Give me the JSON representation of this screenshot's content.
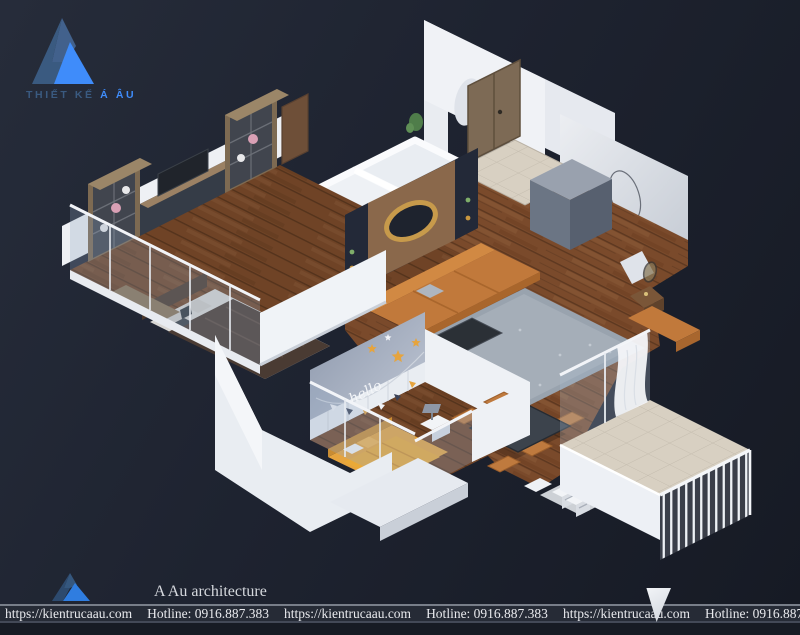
{
  "branding": {
    "logo_top": {
      "title_prefix": "THIẾT KẾ ",
      "title_accent": "Á ÂU"
    },
    "logo_bottom": {
      "name": "A Au architecture"
    }
  },
  "footer": {
    "items": [
      "https://kientrucaau.com",
      "Hotline: 0916.887.383",
      "https://kientrucaau.com",
      "Hotline: 0916.887.383",
      "https://kientrucaau.com",
      "Hotline: 0916.887.383",
      "https://kientrucaau.com"
    ]
  },
  "render": {
    "kids_wall_text": "hello"
  },
  "colors": {
    "bg_dark": "#1b202b",
    "bg_light": "#262c3a",
    "accent_blue": "#3f8cfa",
    "steel_blue": "#3a5a80",
    "footer_bg": "#262b36",
    "footer_text": "#e9eaee",
    "sofa_orange": "#c1793b",
    "kid_orange": "#e6a43e",
    "wall_white": "#f2f4f7"
  }
}
